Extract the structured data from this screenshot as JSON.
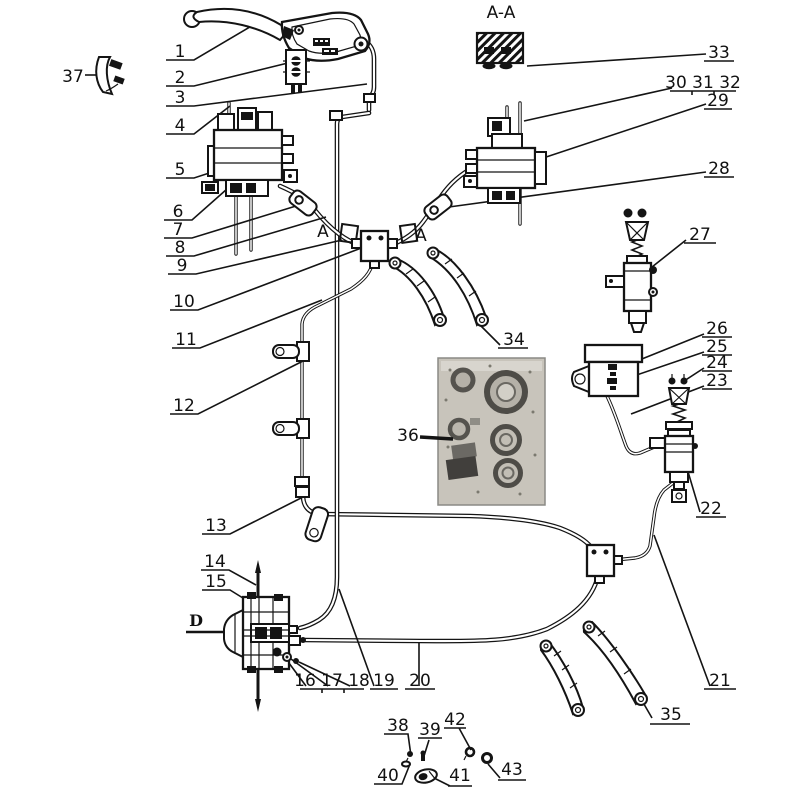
{
  "markers": {
    "section_view": "A-A",
    "section_cut_left": "A",
    "section_cut_right": "A",
    "axis": "D"
  },
  "callouts": {
    "c1": "1",
    "c2": "2",
    "c3": "3",
    "c4": "4",
    "c5": "5",
    "c6": "6",
    "c7": "7",
    "c8": "8",
    "c9": "9",
    "c10": "10",
    "c11": "11",
    "c12": "12",
    "c13": "13",
    "c14": "14",
    "c15": "15",
    "c16_17_18": "16 17 18",
    "c19": "19",
    "c20": "20",
    "c21": "21",
    "c22": "22",
    "c23": "23",
    "c24": "24",
    "c25": "25",
    "c26": "26",
    "c27": "27",
    "c28": "28",
    "c29": "29",
    "c30_31_32": "30 31 32",
    "c33": "33",
    "c34": "34",
    "c35": "35",
    "c36": "36",
    "c37": "37",
    "c38": "38",
    "c39": "39",
    "c40": "40",
    "c41": "41",
    "c42": "42",
    "c43": "43"
  }
}
